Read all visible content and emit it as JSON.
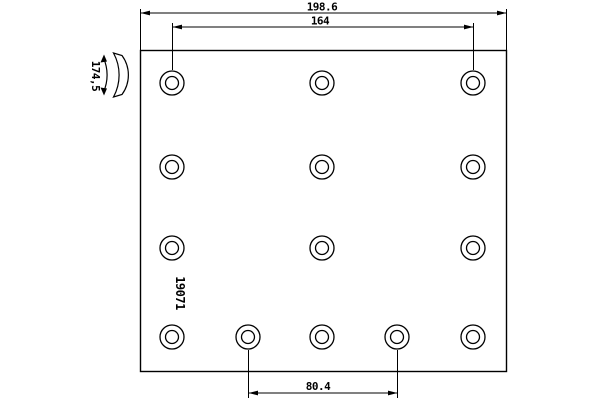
{
  "drawing": {
    "type": "brake-lining-technical-drawing",
    "dimensions": {
      "overall_width": "198.6",
      "upper_hole_span": "164",
      "lower_hole_span": "80.4",
      "arc_radius": "174,5"
    },
    "part_number": "19071",
    "colors": {
      "line": "#000000",
      "background": "#ffffff"
    },
    "holes": {
      "outer_radius": 12,
      "inner_radius": 6.5,
      "rows": [
        {
          "y": 83,
          "xs": [
            172,
            322,
            473
          ]
        },
        {
          "y": 167,
          "xs": [
            172,
            322,
            473
          ]
        },
        {
          "y": 248,
          "xs": [
            172,
            322,
            473
          ]
        },
        {
          "y": 337,
          "xs": [
            172,
            248,
            322,
            397,
            473
          ]
        }
      ]
    }
  }
}
